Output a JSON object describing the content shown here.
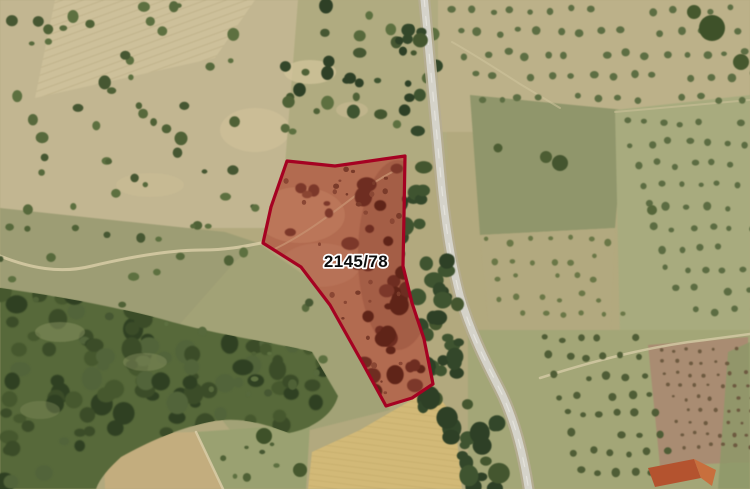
{
  "map": {
    "title": "aerial-cadastral-view",
    "parcel": {
      "label": "2145/78",
      "points": "287,161 335,166 405,156 404,215 403,266 412,303 424,339 433,384 412,398 386,406 362,362 330,305 301,267 263,243 271,207",
      "border_color": "#a50222",
      "fill_base": "#b26b50",
      "label_color": "#0d0d0d",
      "label_halo": "#ffffff"
    }
  }
}
